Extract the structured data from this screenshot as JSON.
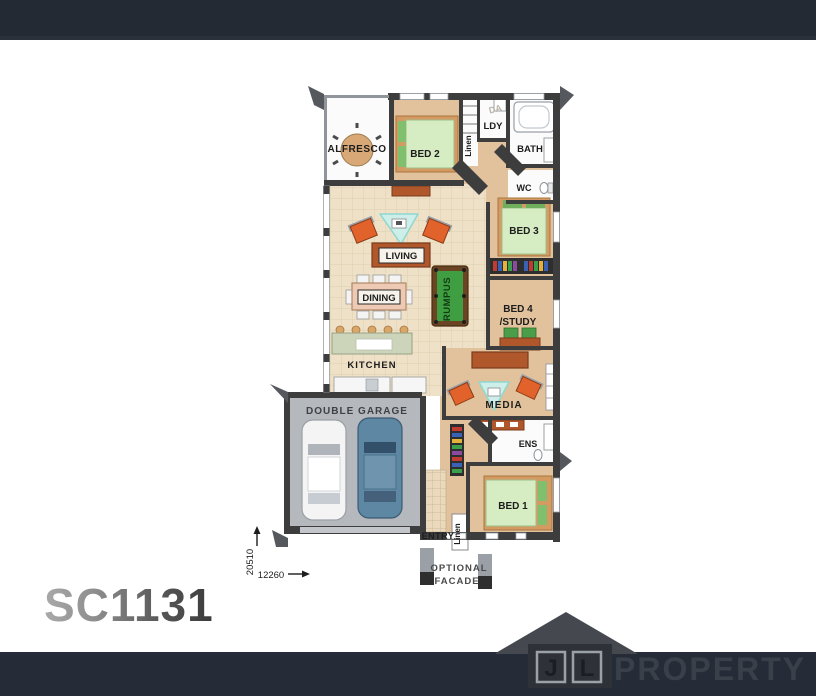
{
  "page": {
    "header_bg": "#232a33",
    "footer_bg": "#252c37",
    "background": "#ffffff"
  },
  "plan": {
    "code": "SC1131",
    "labels": {
      "alfresco": "ALFRESCO",
      "bed2": "BED 2",
      "ldy": "LDY",
      "da": "DA",
      "bath": "BATH",
      "wc": "WC",
      "linen_top": "Linen",
      "bed3": "BED 3",
      "living": "LIVING",
      "dining": "DINING",
      "rumpus": "RUMPUS",
      "bed4_line1": "BED 4",
      "bed4_line2": "/STUDY",
      "kitchen": "KITCHEN",
      "media": "MEDIA",
      "garage": "DOUBLE GARAGE",
      "ens": "ENS",
      "bed1": "BED 1",
      "entry": "ENTRY",
      "linen_bottom": "Linen",
      "optional_line1": "OPTIONAL",
      "optional_line2": "FACADE"
    },
    "dimensions": {
      "depth_mm": "20510",
      "width_mm": "12260"
    },
    "colors": {
      "wall": "#3d3d3d",
      "floor_living": "#eee1c8",
      "floor_bedroom": "#e2c29c",
      "floor_garage": "#b5b9bd",
      "floor_wet": "#fbfbfb",
      "sofa": "#b0582c",
      "armchair": "#e2622b",
      "mattress": "#d6ecc2",
      "pool_table": "#3f9e41",
      "rug": "#cdeee9"
    }
  },
  "logo": {
    "initial_j": "J",
    "initial_l": "L",
    "name": "PROPERTY",
    "color": "#3a404a"
  }
}
